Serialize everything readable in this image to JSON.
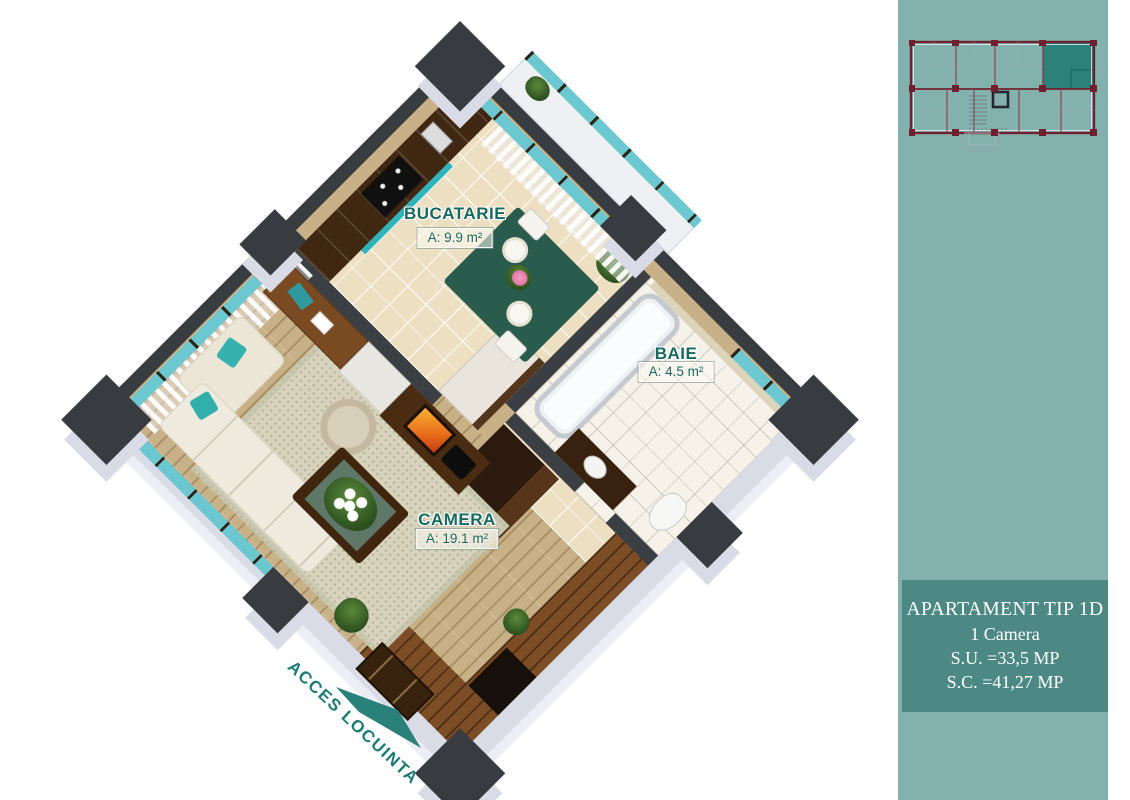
{
  "main": {
    "rooms": [
      {
        "name": "BUCATARIE",
        "area": "A: 9.9 m²"
      },
      {
        "name": "BAIE",
        "area": "A: 4.5 m²"
      },
      {
        "name": "CAMERA",
        "area": "A: 19.1 m²"
      }
    ],
    "entrance": {
      "label": "ACCES LOCUINTA"
    }
  },
  "sidebar": {
    "info": {
      "title": "APARTAMENT TIP 1D",
      "rooms_line": "1 Camera",
      "useful_area": "S.U. =33,5 MP",
      "built_area": "S.C. =41,27 MP"
    }
  },
  "colors": {
    "sidebar_bg": "#83b2ae",
    "panel_bg": "#4d8984",
    "room_label_green": "#15695e",
    "entrance_teal": "#1c7b75",
    "wall_dark": "#383c40",
    "wall_face_light": "#d9dbe7",
    "glass_teal": "#6cc8d0",
    "miniplan_wall_maroon": "#6f1f2d",
    "miniplan_highlight_teal": "#2d817b"
  }
}
